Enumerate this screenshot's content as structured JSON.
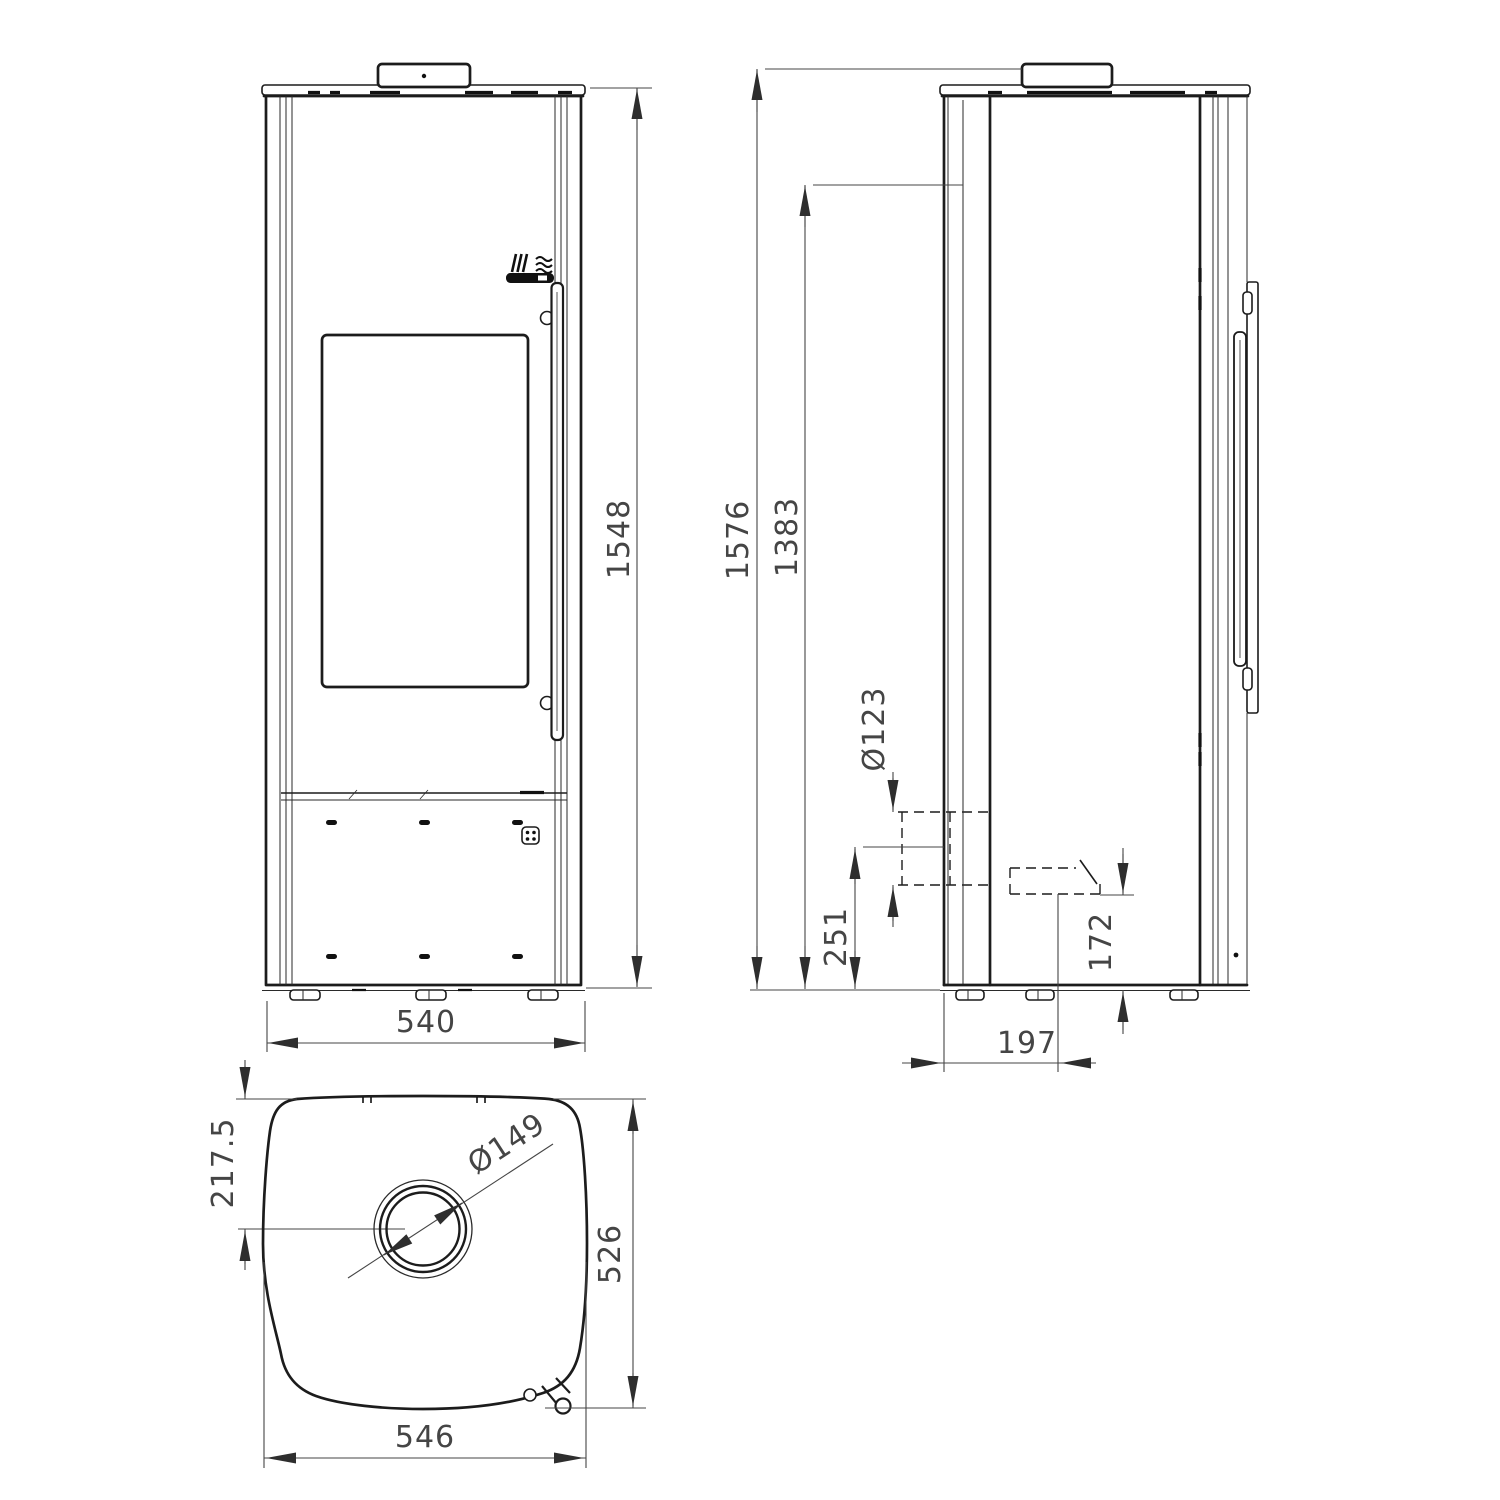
{
  "page": {
    "background": "#ffffff"
  },
  "drawing": {
    "line_color": "#1c1c1c",
    "dimension_color": "#454545",
    "views": {
      "front": {
        "name": "front view",
        "dims": {
          "height": "1548",
          "width": "540"
        }
      },
      "side": {
        "name": "side view",
        "dims": {
          "overall_height": "1576",
          "rear_height": "1383",
          "flue_diameter": "Ø123",
          "flue_center_height": "251",
          "air_inlet_height": "172",
          "air_inlet_setback": "197"
        }
      },
      "top": {
        "name": "top view",
        "dims": {
          "flue_offset": "217.5",
          "flue_collar_diameter": "Ø149",
          "depth": "526",
          "width": "546"
        }
      }
    }
  }
}
